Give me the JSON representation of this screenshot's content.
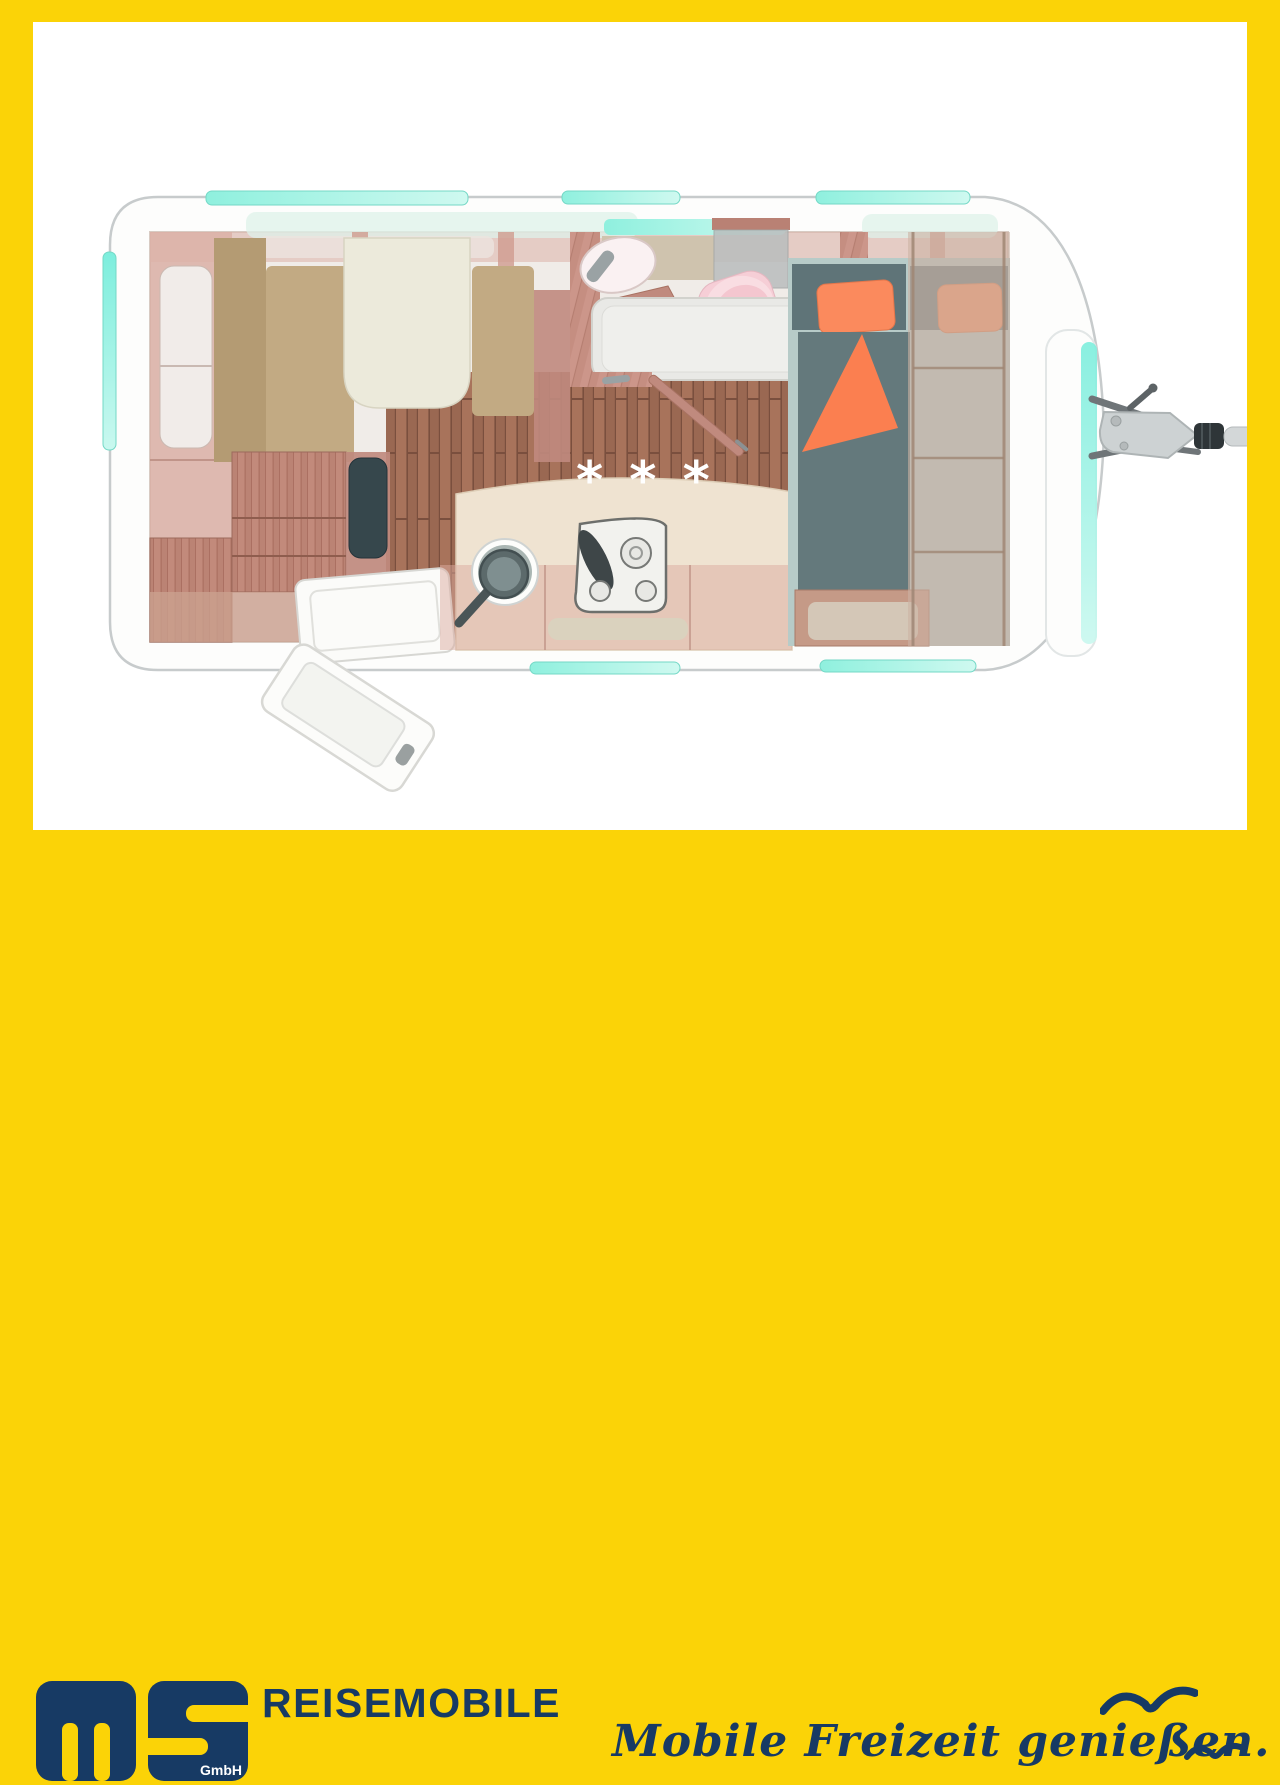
{
  "branding": {
    "logo_text": "ms",
    "logo_suffix": "GmbH",
    "wordmark": "REISEMOBILE",
    "slogan": "Mobile Freizeit genießen."
  },
  "floorplan": {
    "heating_marker": "* * *",
    "description": "caravan top-view floor plan"
  },
  "theme": {
    "yellow": "#FBD307",
    "navy": "#173A64",
    "teal": "#7DEEDD",
    "teal-light": "#C9F8EF",
    "body-stroke": "#C7CBCC",
    "wall-wood": "#C58E81",
    "cabinet-wood": "#BB8374",
    "floor-wood": "#9A6852",
    "cushion-tan": "#C2AA83",
    "cushion-tan-dark": "#B49B73",
    "table-cream": "#ECEADB",
    "counter-cream": "#EFE3D1",
    "slate": "#5F7478",
    "slate-duvet": "#64797C",
    "mattress": "#B7CBC8",
    "orange-pillow": "#FB8A5D",
    "orange-blanket": "#FB7F50",
    "pink-sanitary": "#F6CED6",
    "tv-black": "#36474C",
    "hitch-gray": "#CDD2D3"
  }
}
